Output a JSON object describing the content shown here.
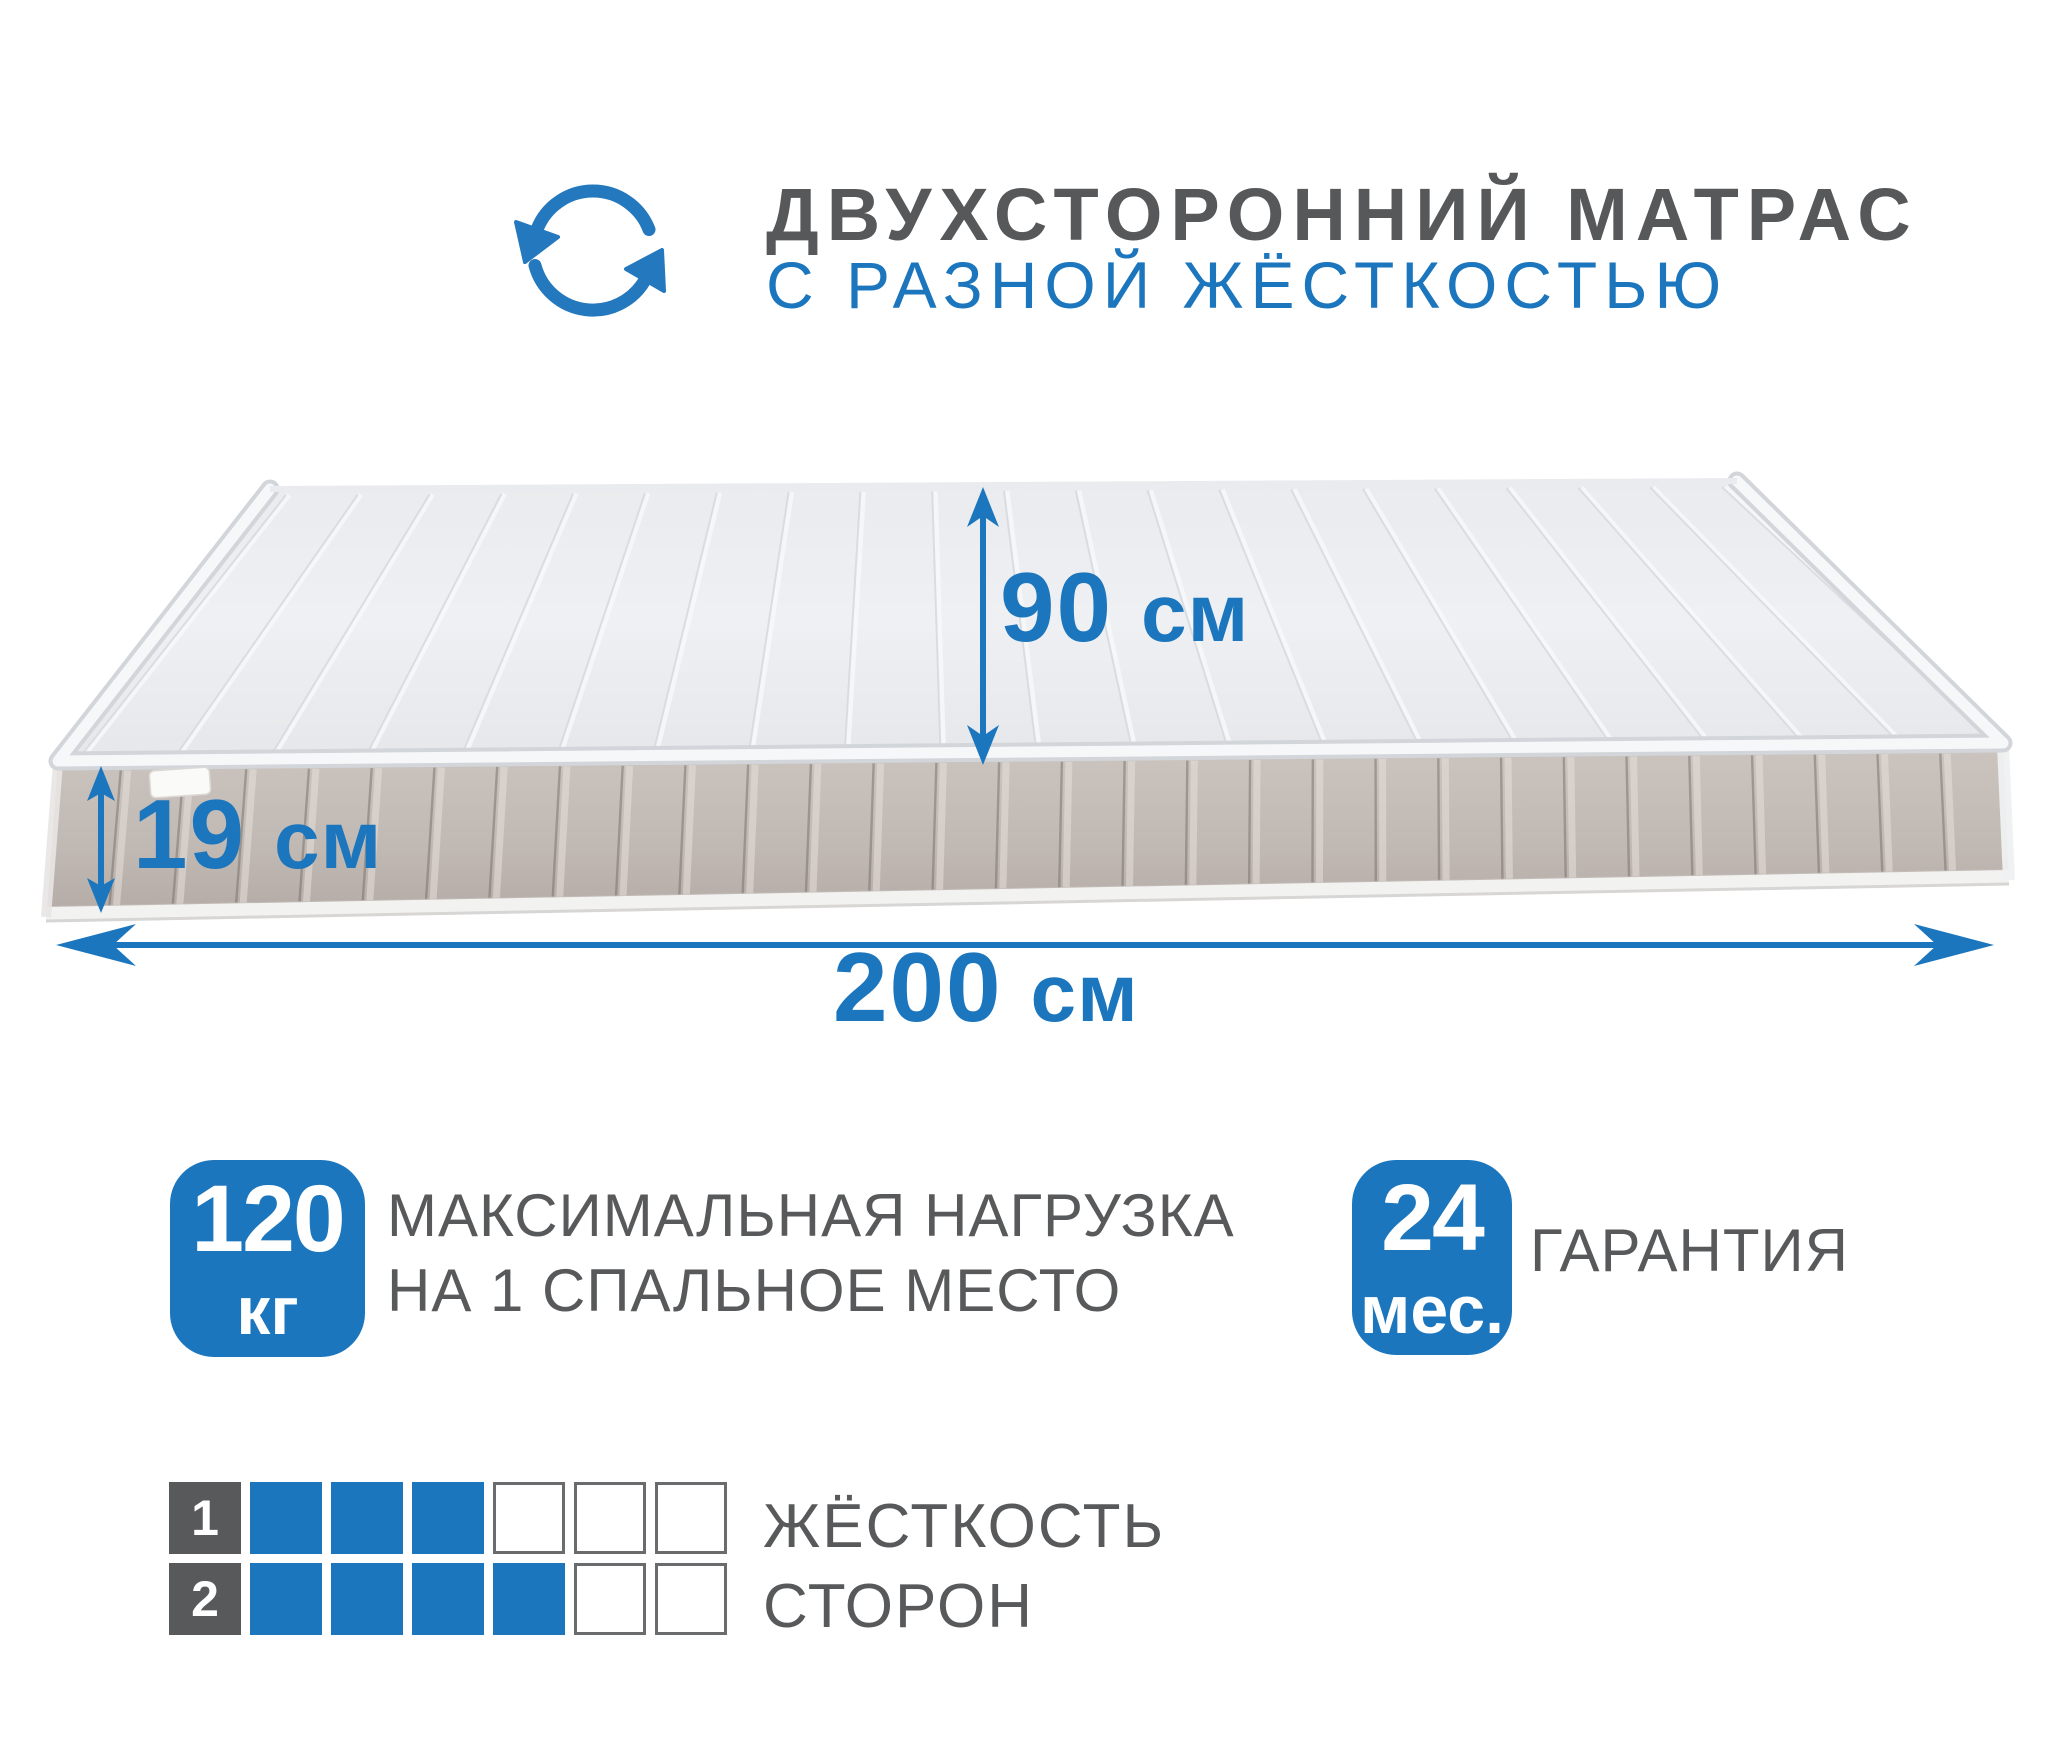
{
  "header": {
    "icon": "rotate-arrows",
    "title": "ДВУХСТОРОННИЙ МАТРАС",
    "subtitle": "С РАЗНОЙ ЖЁСТКОСТЬЮ"
  },
  "mattress": {
    "top_width_label": {
      "value": "90",
      "unit": "см"
    },
    "thickness_label": {
      "value": "19",
      "unit": "см"
    },
    "length_label": {
      "value": "200",
      "unit": "см"
    }
  },
  "features": {
    "max_load": {
      "value": "120",
      "unit": "кг",
      "description_line1": "МАКСИМАЛЬНАЯ НАГРУЗКА",
      "description_line2": "НА 1 СПАЛЬНОЕ МЕСТО"
    },
    "warranty": {
      "value": "24",
      "unit": "мес.",
      "label": "ГАРАНТИЯ"
    }
  },
  "firmness": {
    "label_line1": "ЖЁСТКОСТЬ",
    "label_line2": "СТОРОН",
    "scale_max": 6,
    "rows": [
      {
        "side": "1",
        "filled": 3
      },
      {
        "side": "2",
        "filled": 4
      }
    ]
  },
  "colors": {
    "accent_blue": "#1c76bd",
    "text_gray": "#58595b",
    "side_fabric": "#c2bab4",
    "top_fabric": "#eceef1"
  }
}
